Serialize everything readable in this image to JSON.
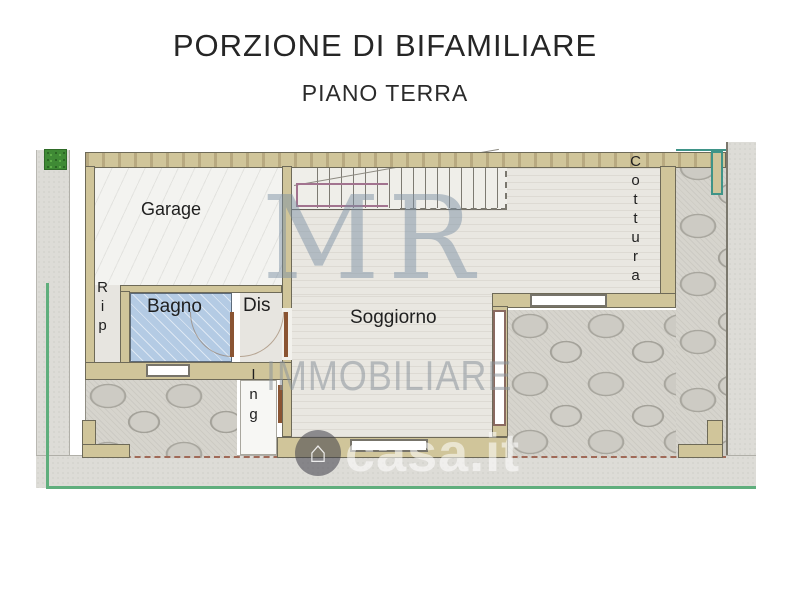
{
  "title": "PORZIONE DI BIFAMILIARE",
  "subtitle": "PIANO TERRA",
  "plan": {
    "rooms": {
      "garage": "Garage",
      "rip": "Rip",
      "bagno": "Bagno",
      "dis": "Dis",
      "ing": "Ing",
      "soggiorno": "Soggiorno",
      "cottura": "Cottura"
    }
  },
  "watermark": {
    "initials": "MR",
    "brand": "IMMOBILIARE",
    "site": "casa.it",
    "house_icon": "⌂"
  },
  "colors": {
    "wall_tan": "#d0c59a",
    "bagno_floor_blue": "#b4cbe4",
    "stone_patio": "#d6d4cd",
    "walkway_concrete": "#dddcd7",
    "boundary_green": "#5fae7c",
    "teal_accent": "#3f9488",
    "property_dashed": "#a06a58",
    "watermark_gray": "#7a8ea2"
  }
}
